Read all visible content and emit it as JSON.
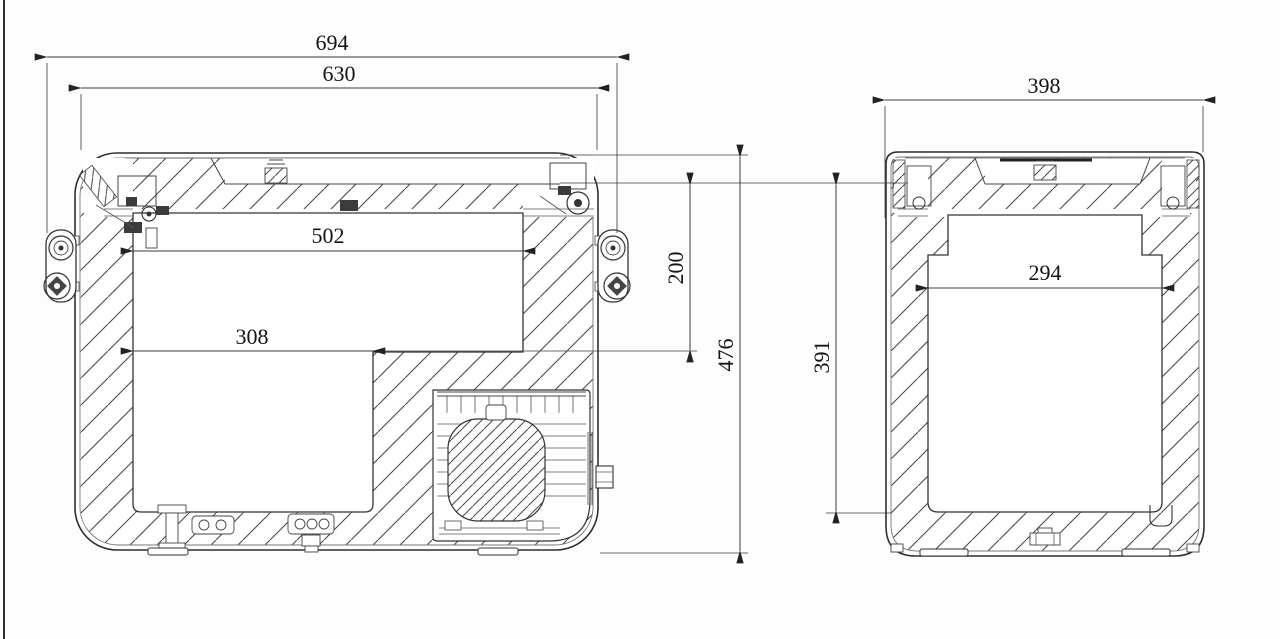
{
  "drawing": {
    "type": "technical-cross-section-drawing",
    "subject": "portable compressor cooler box — two sectional views with dimensions (mm)",
    "front_view": {
      "dims": {
        "overall_width_with_handles": "694",
        "body_width": "630",
        "interior_width_upper": "502",
        "interior_width_lower": "308",
        "compressor_step_height": "200",
        "overall_height": "476"
      }
    },
    "side_view": {
      "dims": {
        "overall_depth": "398",
        "interior_depth": "294",
        "interior_height": "391"
      }
    }
  }
}
